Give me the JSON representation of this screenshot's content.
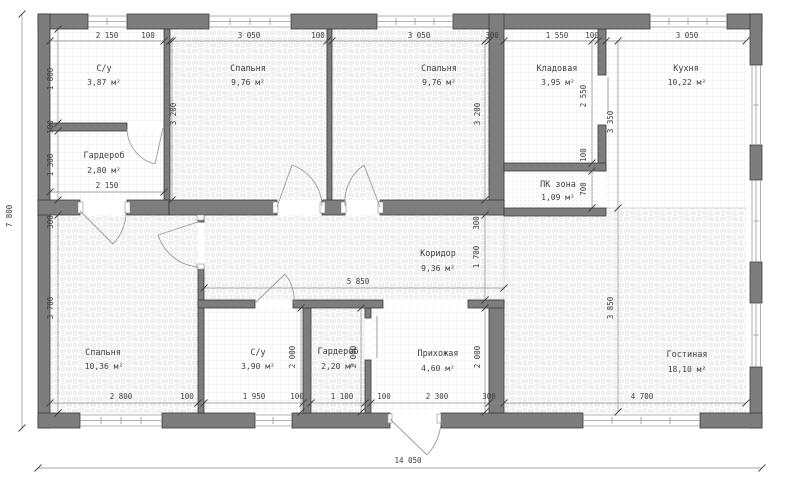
{
  "plan": {
    "overall": {
      "width": "14 050",
      "height": "7 800"
    },
    "rooms": [
      {
        "name": "С/у",
        "area": "3,87 м²"
      },
      {
        "name": "Спальня",
        "area": "9,76 м²"
      },
      {
        "name": "Спальня",
        "area": "9,76 м²"
      },
      {
        "name": "Кладовая",
        "area": "3,95 м²"
      },
      {
        "name": "Кухня",
        "area": "10,22 м²"
      },
      {
        "name": "Гардероб",
        "area": "2,80 м²"
      },
      {
        "name": "ПК зона",
        "area": "1,09 м²"
      },
      {
        "name": "Коридор",
        "area": "9,36 м²"
      },
      {
        "name": "Спальня",
        "area": "10,36 м²"
      },
      {
        "name": "С/у",
        "area": "3,90 м²"
      },
      {
        "name": "Гардероб",
        "area": "2,20 м²"
      },
      {
        "name": "Прихожая",
        "area": "4,60 м²"
      },
      {
        "name": "Гостиная",
        "area": "18,10 м²"
      }
    ],
    "dims": [
      "2 150",
      "100",
      "3 050",
      "100",
      "3 050",
      "300",
      "1 550",
      "100",
      "3 050",
      "1 800",
      "100",
      "1 300",
      "300",
      "3 700",
      "3 200",
      "3 200",
      "2 550",
      "100",
      "700",
      "3 350",
      "300",
      "1 700",
      "3 850",
      "2 150",
      "5 850",
      "2 000",
      "2 000",
      "2 000",
      "2 800",
      "100",
      "1 950",
      "100",
      "1 100",
      "100",
      "2 300",
      "300",
      "4 700"
    ]
  }
}
